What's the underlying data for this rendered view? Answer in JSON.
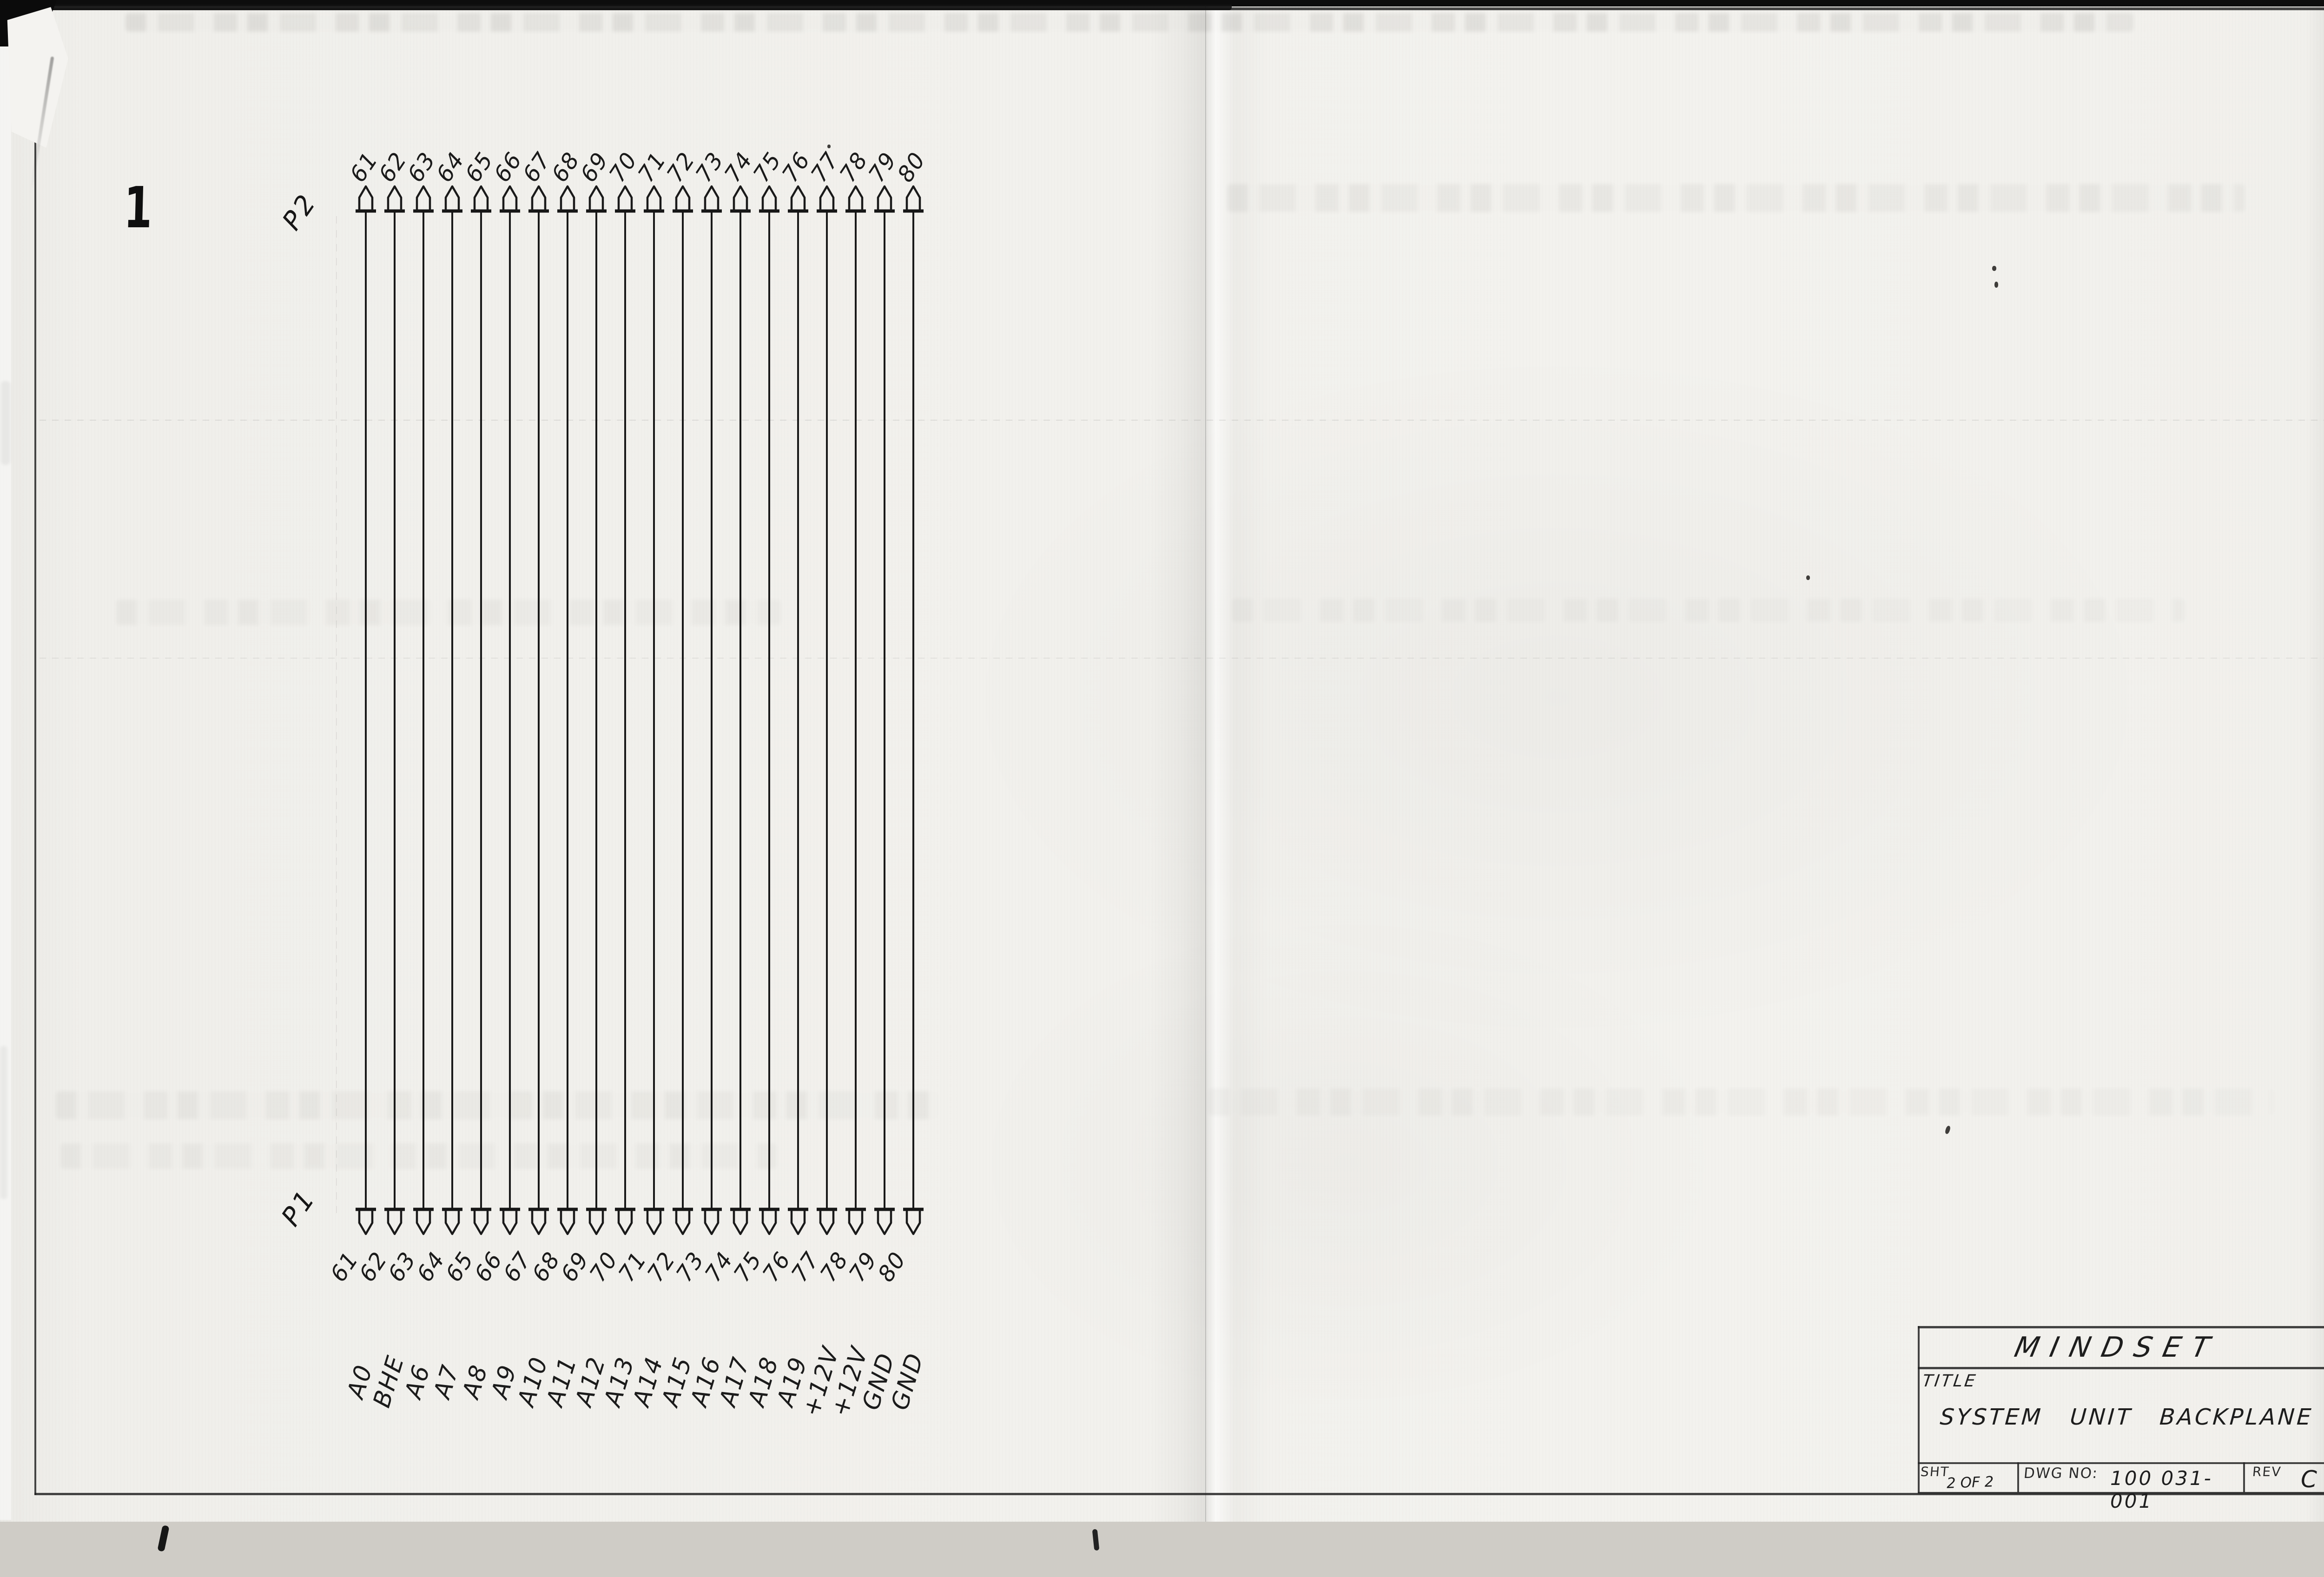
{
  "sheet": {
    "page_mark": "1",
    "top_connector": "P2",
    "bottom_connector": "P1",
    "pins": [
      {
        "number": "61",
        "signal": "A0"
      },
      {
        "number": "62",
        "signal": "BHE"
      },
      {
        "number": "63",
        "signal": "A6"
      },
      {
        "number": "64",
        "signal": "A7"
      },
      {
        "number": "65",
        "signal": "A8"
      },
      {
        "number": "66",
        "signal": "A9"
      },
      {
        "number": "67",
        "signal": "A10"
      },
      {
        "number": "68",
        "signal": "A11"
      },
      {
        "number": "69",
        "signal": "A12"
      },
      {
        "number": "70",
        "signal": "A13"
      },
      {
        "number": "71",
        "signal": "A14"
      },
      {
        "number": "72",
        "signal": "A15"
      },
      {
        "number": "73",
        "signal": "A16"
      },
      {
        "number": "74",
        "signal": "A17"
      },
      {
        "number": "75",
        "signal": "A18"
      },
      {
        "number": "76",
        "signal": "A19"
      },
      {
        "number": "77",
        "signal": "+12V"
      },
      {
        "number": "78",
        "signal": "+12V"
      },
      {
        "number": "79",
        "signal": "GND"
      },
      {
        "number": "80",
        "signal": "GND"
      }
    ],
    "title_block": {
      "company": "MINDSET",
      "title_label": "TITLE",
      "title": "SYSTEM UNIT BACKPLANE",
      "sheet_label": "SHT",
      "sheet_value": "2 OF 2",
      "dwg_label": "DWG NO:",
      "dwg_value": "100 031-001",
      "rev_label": "REV",
      "rev_value": "C"
    }
  },
  "colors": {
    "ink": "#1c1c1c",
    "paper": "#f1f0ec",
    "scanner_strip": "#c9c6c0",
    "scanner_edge": "#0d0d0d"
  }
}
